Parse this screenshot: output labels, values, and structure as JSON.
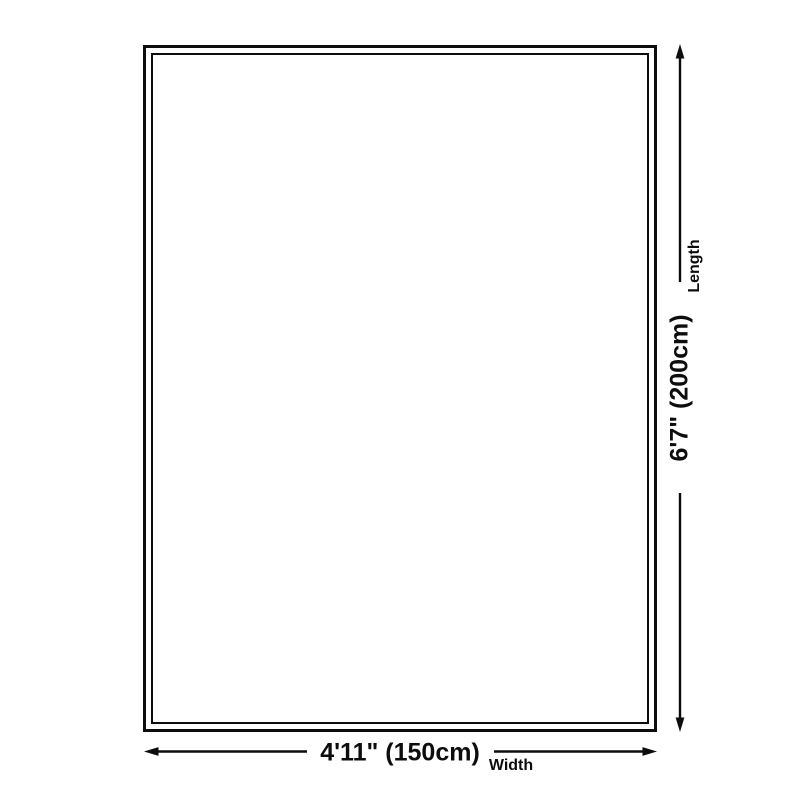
{
  "diagram": {
    "background_color": "#ffffff",
    "line_color": "#0d0d0d",
    "length": {
      "value": "6'7\" (200cm)",
      "label": "Length"
    },
    "width": {
      "value": "4'11\" (150cm)",
      "label": "Width"
    }
  }
}
